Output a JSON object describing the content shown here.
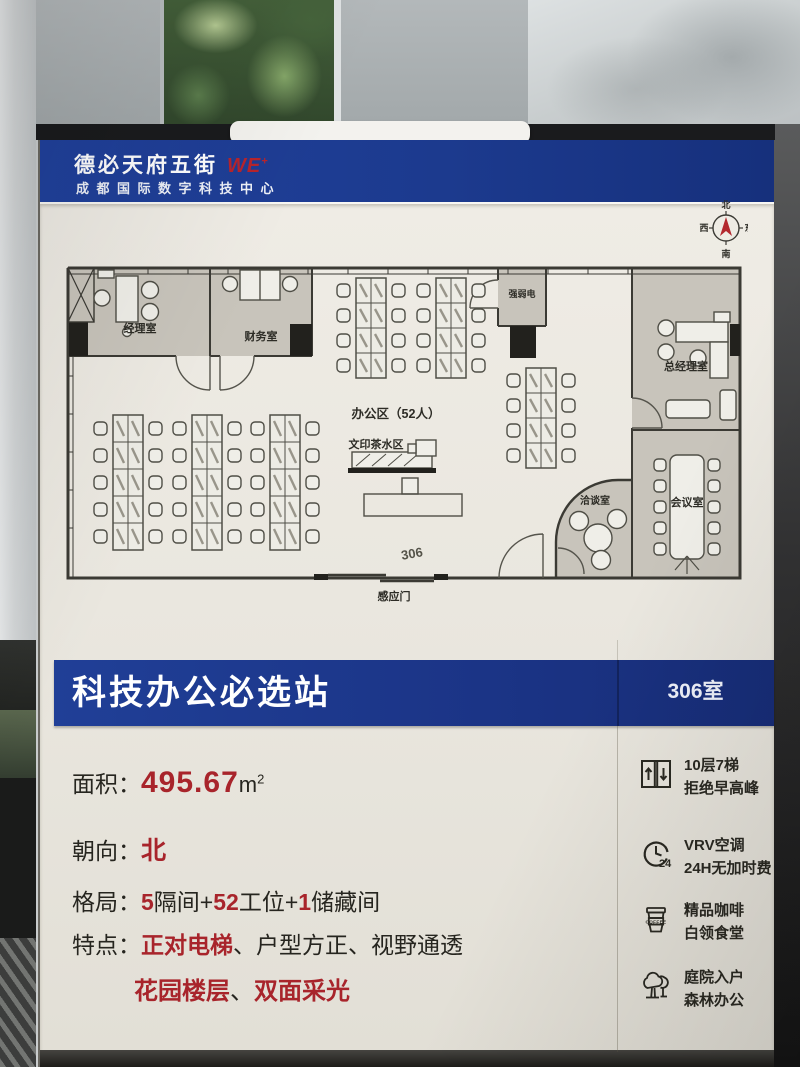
{
  "header": {
    "brand": "德必天府五街",
    "brand_mark": "WE",
    "brand_sup": "+",
    "subtitle": "成都国际数字科技中心"
  },
  "floor_plan": {
    "compass": {
      "n": "北",
      "s": "南",
      "e": "东",
      "w": "西"
    },
    "labels": {
      "manager_office": "经理室",
      "finance_office": "财务室",
      "open_office": "办公区（52人）",
      "print_tea_area": "文印茶水区",
      "utility_room": "强弱电",
      "gm_office": "总经理室",
      "meeting_room": "会议室",
      "negotiation_room": "洽谈室",
      "room_number": "306",
      "entrance_door": "感应门"
    }
  },
  "banner": {
    "title": "科技办公必选站",
    "room_tag": "306室"
  },
  "details": {
    "area": {
      "label": "面积：",
      "value": "495.67",
      "unit": "m",
      "unit_sup": "2"
    },
    "orientation": {
      "label": "朝向：",
      "value": "北"
    },
    "layout": {
      "label": "格局：",
      "segments": [
        {
          "text": "5",
          "red": true
        },
        {
          "text": "隔间+",
          "red": false
        },
        {
          "text": "52",
          "red": true
        },
        {
          "text": "工位+",
          "red": false
        },
        {
          "text": "1",
          "red": true
        },
        {
          "text": "储藏间",
          "red": false
        }
      ]
    },
    "features": {
      "label": "特点：",
      "line1": [
        {
          "text": "正对电梯",
          "red": true
        },
        {
          "text": "、",
          "red": false
        },
        {
          "text": "户型方正",
          "red": false
        },
        {
          "text": "、",
          "red": false
        },
        {
          "text": "视野通透",
          "red": false
        }
      ],
      "line2": [
        {
          "text": "花园楼层",
          "red": true
        },
        {
          "text": "、",
          "red": false
        },
        {
          "text": "双面采光",
          "red": true
        }
      ]
    }
  },
  "amenities": [
    {
      "icon": "elevator-icon",
      "line1": "10层7梯",
      "line2": "拒绝早高峰"
    },
    {
      "icon": "clock-24h-icon",
      "line1": "VRV空调",
      "line2": "24H无加时费",
      "badge": "24"
    },
    {
      "icon": "coffee-icon",
      "line1": "精品咖啡",
      "line2": "白领食堂",
      "badge": "COFFEE"
    },
    {
      "icon": "trees-icon",
      "line1": "庭院入户",
      "line2": "森林办公"
    }
  ],
  "colors": {
    "banner_blue": "#1c3a8e",
    "accent_red": "#a8242b",
    "poster_cream": "#e9e6de",
    "ink": "#26251f"
  }
}
